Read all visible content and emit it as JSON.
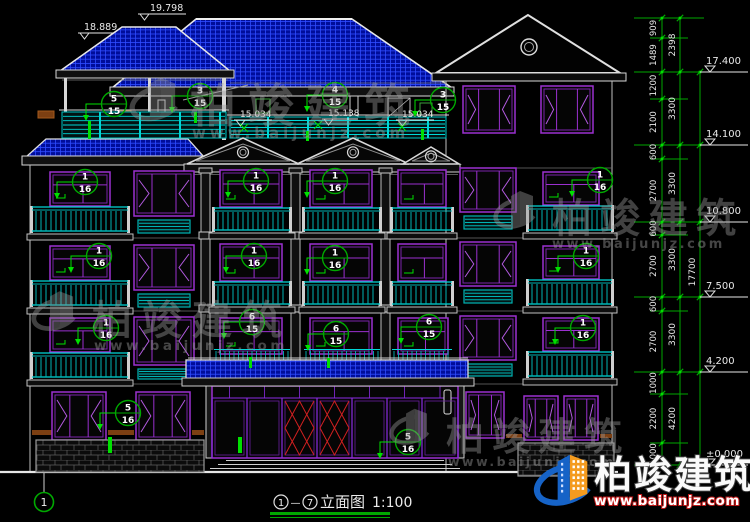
{
  "drawing": {
    "roof_levels": [
      "19.798",
      "18.889",
      "15.034",
      "15.138",
      "15.034"
    ],
    "right_levels": [
      "17.400",
      "14.100",
      "10.800",
      "7.500",
      "4.200",
      "±0.000"
    ],
    "dims": {
      "segments": [
        "909",
        "1489",
        "1200",
        "2100",
        "600",
        "2700",
        "600",
        "2700",
        "600",
        "2700",
        "1000",
        "2200",
        "1000"
      ],
      "floors": [
        "2398",
        "3300",
        "3300",
        "3300",
        "3300",
        "4200"
      ],
      "overall": "17700"
    },
    "callouts": [
      {
        "top": "5",
        "bottom": "15"
      },
      {
        "top": "3",
        "bottom": "15"
      },
      {
        "top": "4",
        "bottom": "15"
      },
      {
        "top": "3",
        "bottom": "15"
      },
      {
        "top": "1",
        "bottom": "16"
      },
      {
        "top": "1",
        "bottom": "16"
      },
      {
        "top": "1",
        "bottom": "16"
      },
      {
        "top": "1",
        "bottom": "16"
      },
      {
        "top": "1",
        "bottom": "16"
      },
      {
        "top": "1",
        "bottom": "16"
      },
      {
        "top": "1",
        "bottom": "16"
      },
      {
        "top": "1",
        "bottom": "16"
      },
      {
        "top": "1",
        "bottom": "16"
      },
      {
        "top": "6",
        "bottom": "15"
      },
      {
        "top": "6",
        "bottom": "15"
      },
      {
        "top": "6",
        "bottom": "15"
      },
      {
        "top": "1",
        "bottom": "16"
      },
      {
        "top": "5",
        "bottom": "16"
      },
      {
        "top": "5",
        "bottom": "16"
      }
    ],
    "axis": {
      "start": "1"
    },
    "title": {
      "axis_start": "1",
      "separator": "—",
      "axis_end": "7",
      "name": "立面图",
      "scale": "1:100"
    }
  },
  "watermark": {
    "brand": "柏竣建筑",
    "site": "www.baijunjz.com"
  },
  "colors": {
    "background": "#000000",
    "dim_green": "#00a800",
    "leader_green": "#00e000",
    "window_purple": "#9b30d0",
    "railing_cyan": "#00b4b4",
    "roof_blue": "#000d9a",
    "door_red": "#d02020",
    "logo_blue": "#1663c7",
    "logo_orange": "#f49b1f"
  }
}
